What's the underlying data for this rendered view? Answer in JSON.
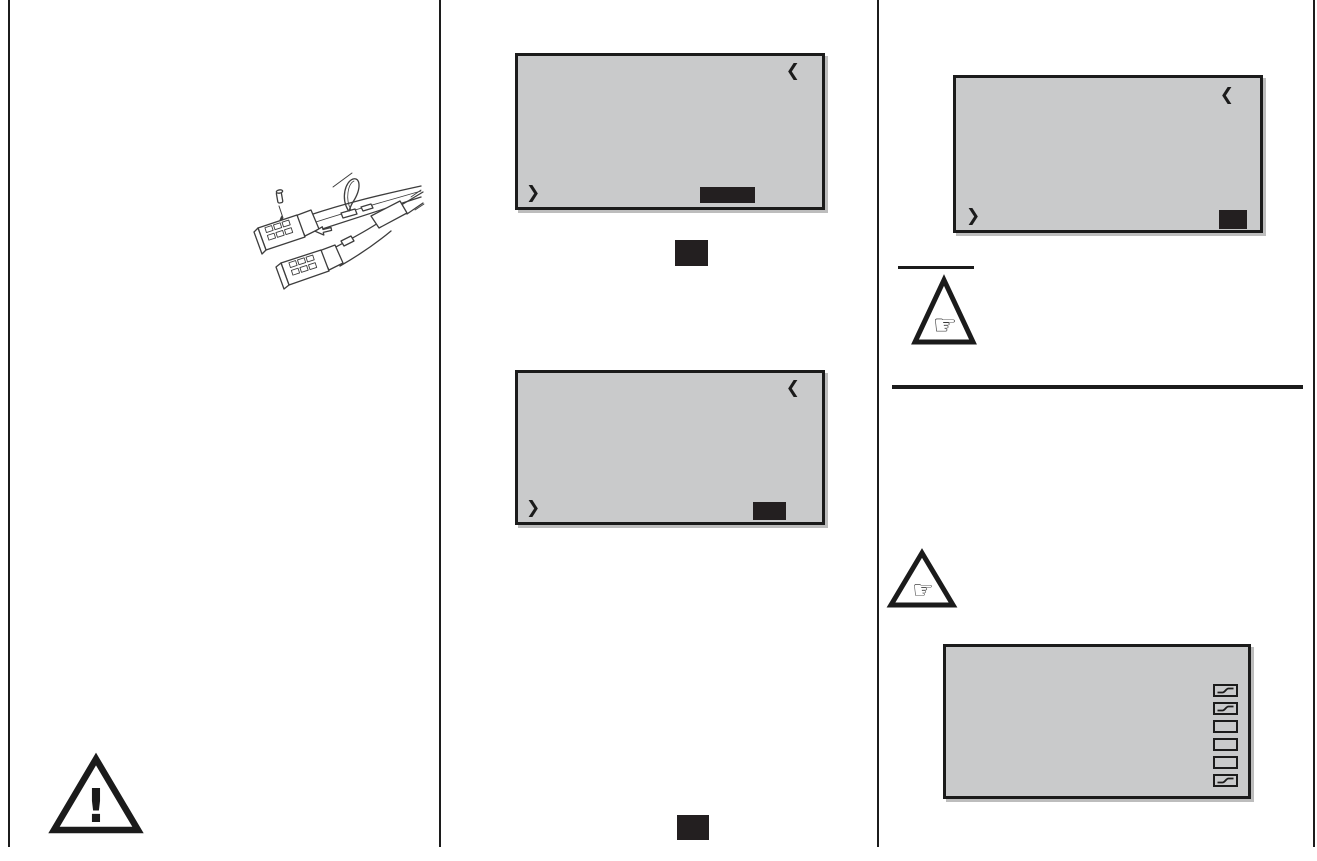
{
  "page": {
    "type": "manual-page",
    "background": "#ffffff",
    "divider_color": "#1c1c1c",
    "columns": 3
  },
  "colors": {
    "screen_bg": "#c9cacb",
    "screen_border": "#1b1b1b",
    "softkey_fill": "#231f20",
    "line_art_stroke": "#3d3d3d"
  },
  "glyphs": {
    "chevron_back": "❮",
    "chevron_forward": "❯",
    "pointing_hand": "☞",
    "warning_mark": "!"
  },
  "screens": {
    "screen1": {
      "content": "",
      "softkey_label": ""
    },
    "screen2": {
      "content": "",
      "softkey_label": ""
    },
    "screen3": {
      "content": "",
      "softkey_label": ""
    },
    "curve_screen": {
      "content": "",
      "icons": [
        {
          "type": "curve"
        },
        {
          "type": "curve"
        },
        {
          "type": "blank"
        },
        {
          "type": "blank"
        },
        {
          "type": "blank"
        },
        {
          "type": "curve"
        }
      ]
    }
  },
  "keys": {
    "key1_label": "",
    "key2_label": ""
  },
  "illustration": {
    "subject": "servo-cable-with-safety-clip"
  }
}
